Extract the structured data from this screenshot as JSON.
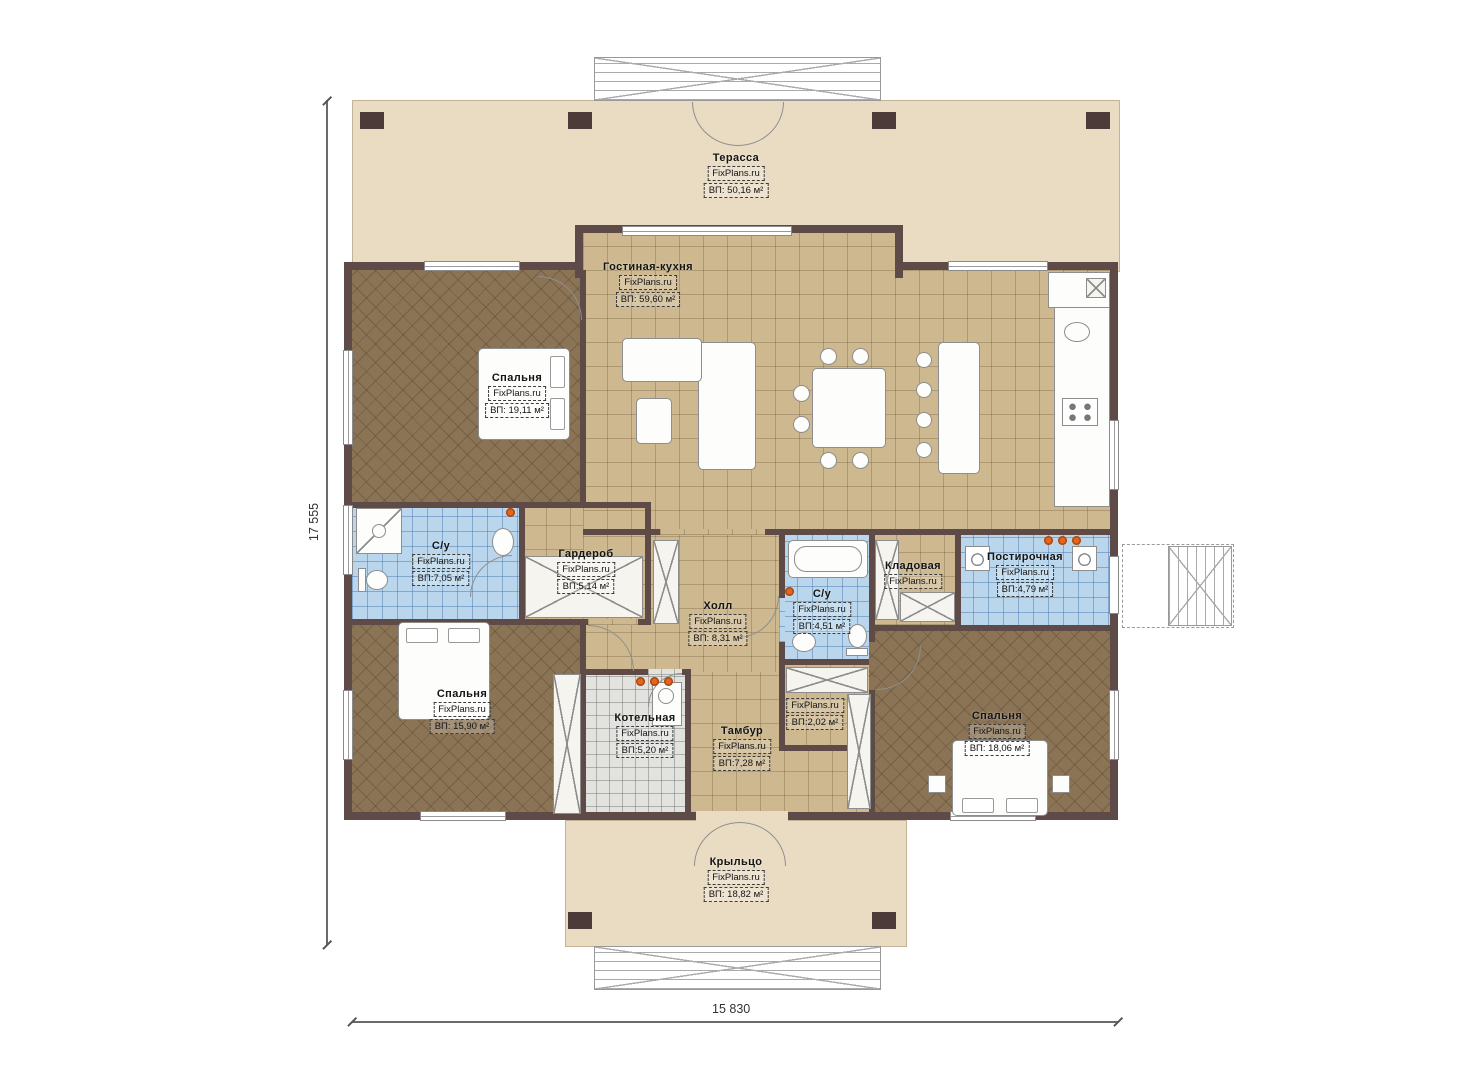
{
  "watermark": "FixPlans.ru",
  "dimensions": {
    "vertical": "17 555",
    "horizontal": "15 830"
  },
  "rooms": {
    "terrace": {
      "name": "Терасса",
      "area": "ВП: 50,16 м²"
    },
    "living": {
      "name": "Гостиная-кухня",
      "area": "ВП: 59,60 м²"
    },
    "bedroom_tl": {
      "name": "Спальня",
      "area": "ВП: 19,11 м²"
    },
    "bath_tl": {
      "name": "С/у",
      "area": "ВП:7,05 м²"
    },
    "wardrobe": {
      "name": "Гардероб",
      "area": "ВП:5,14 м²"
    },
    "hall": {
      "name": "Холл",
      "area": "ВП: 8,31 м²"
    },
    "bath_mid": {
      "name": "С/у",
      "area": "ВП:4,51 м²"
    },
    "pantry": {
      "name": "Кладовая",
      "area": ""
    },
    "laundry": {
      "name": "Постирочная",
      "area": "ВП:4,79 м²"
    },
    "bedroom_bl": {
      "name": "Спальня",
      "area": "ВП: 15,90 м²"
    },
    "boiler": {
      "name": "Котельная",
      "area": "ВП:5,20 м²"
    },
    "tambour": {
      "name": "Тамбур",
      "area": "ВП:7,28 м²"
    },
    "closet": {
      "name": "",
      "area": "ВП:2,02 м²"
    },
    "bedroom_br": {
      "name": "Спальня",
      "area": "ВП: 18,06 м²"
    },
    "porch": {
      "name": "Крыльцо",
      "area": "ВП: 18,82 м²"
    }
  },
  "colors": {
    "wall": "#5e4a47",
    "terrace_fill": "#e9dcc3",
    "floor_tan": "#cdb88f",
    "floor_brown": "#8b7355",
    "floor_blue": "#b9d6ec",
    "floor_gray": "#e2e2df",
    "accent_orange": "#e2661f"
  }
}
